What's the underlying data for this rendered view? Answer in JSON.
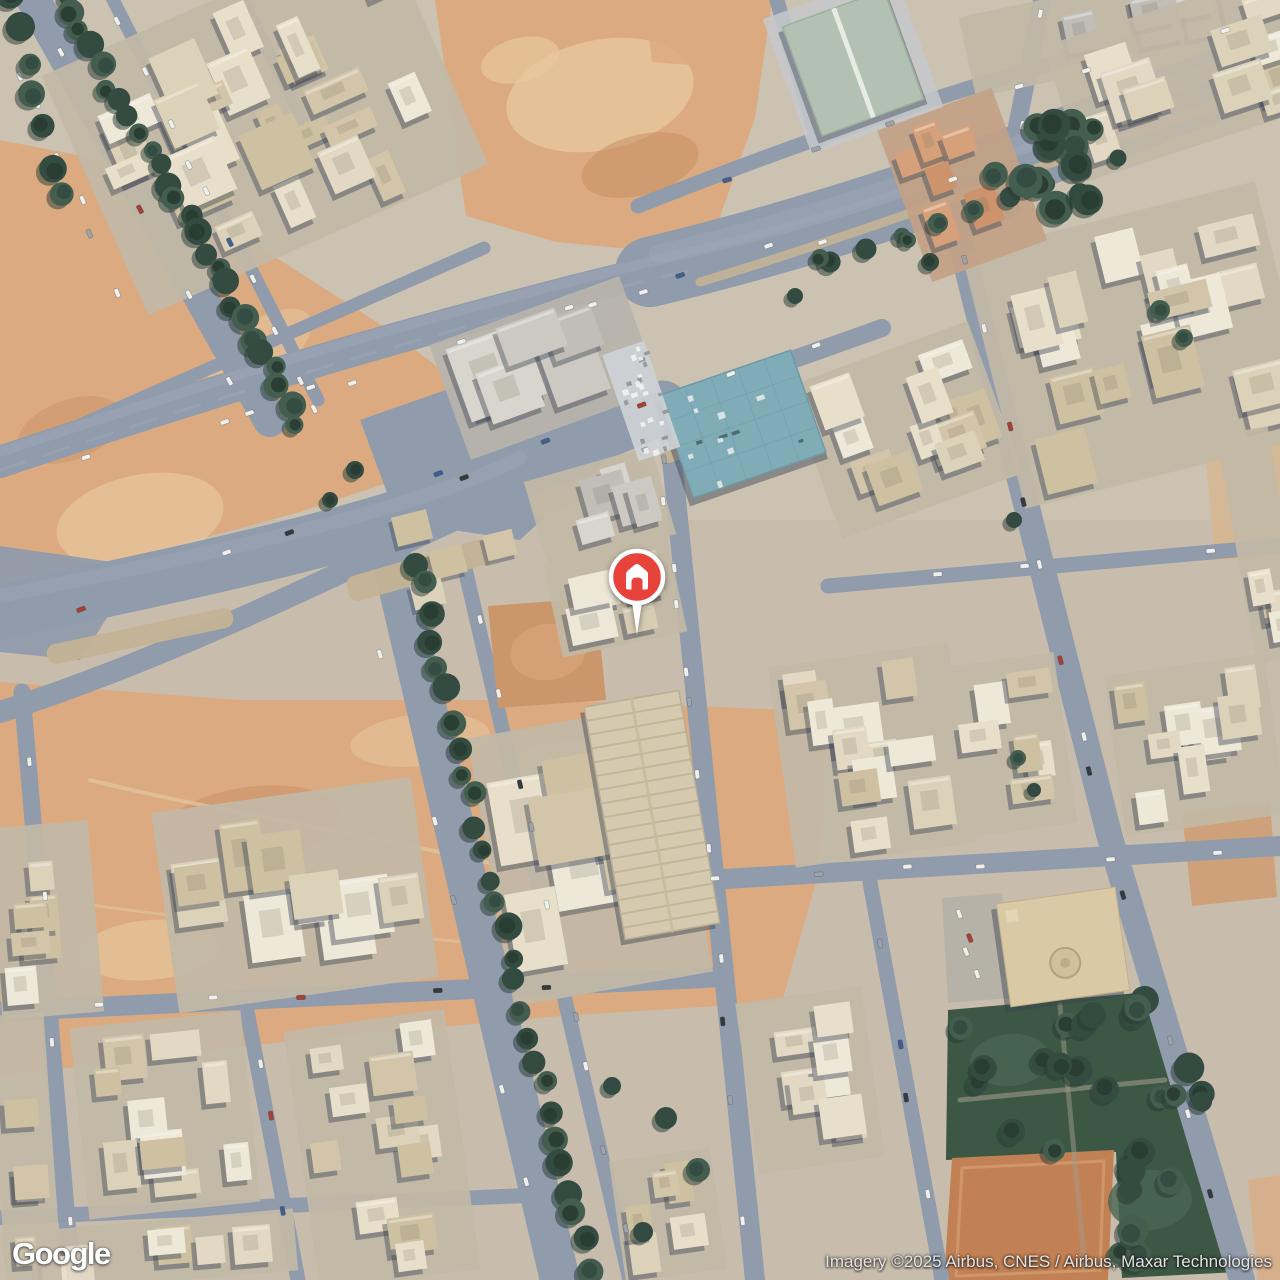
{
  "map": {
    "view_type": "satellite",
    "logo_text": "Google",
    "attribution": "Imagery ©2025 Airbus, CNES / Airbus, Maxar Technologies",
    "marker": {
      "kind": "home",
      "x": 637,
      "y": 577,
      "color": "#E8433A",
      "glyph": "house-icon"
    },
    "colors": {
      "ground": "#c9bdac",
      "ground_north": "#cec4b3",
      "road": "#8e99ac",
      "road_light": "#9da7b9",
      "sand": "#dda97e",
      "sand_light": "#e9c79e",
      "sand_dark": "#c28457",
      "median": "#c4b294",
      "clay_lot": "#cd9468",
      "building_palette": [
        "#eae1cc",
        "#ded3ba",
        "#d3c6a9",
        "#f0eadb",
        "#cfc1a2",
        "#e4dac4"
      ],
      "building_gray": [
        "#cdcac3",
        "#d9d6cf",
        "#c1beb8"
      ],
      "terracotta": [
        "#cd9169",
        "#d7a078"
      ],
      "shadow": "#333b4d",
      "tree": "#2c453c",
      "tree_dark": "#20342b",
      "tree_light": "#3d584a",
      "teal_roof": "#7dabb8",
      "warehouse_roof": "#b2c1b1",
      "park": "#35523f",
      "court_clay": "#c27e50",
      "car_white": "#f2f3f0",
      "car_dark": "#2e3338"
    }
  }
}
